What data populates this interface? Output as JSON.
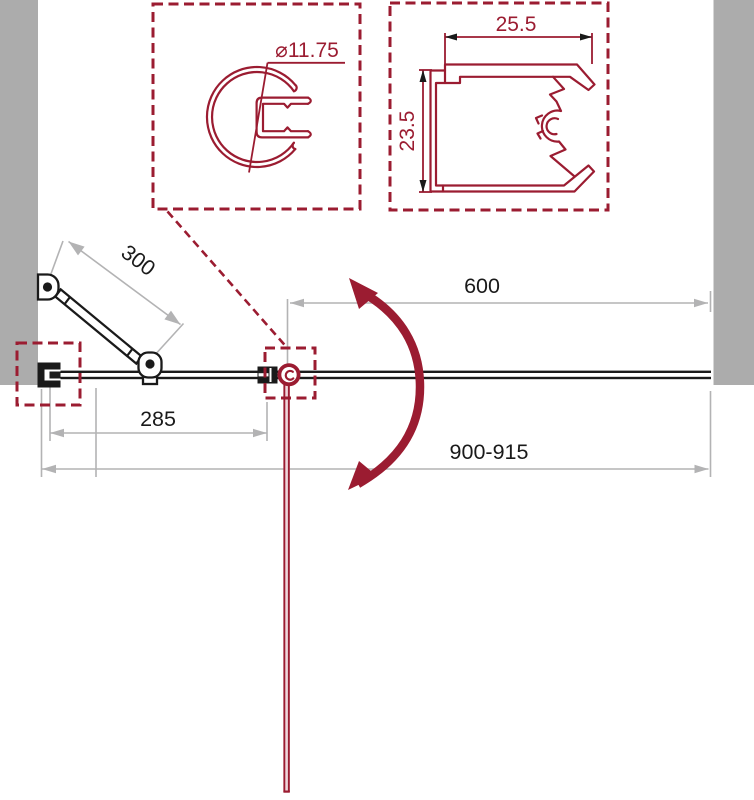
{
  "colors": {
    "red": "#9B1C31",
    "wall": "#ACACAC",
    "dim": "#B3B3B4",
    "ink": "#1A1A1A",
    "doorpink": "#EFD6DC"
  },
  "detail_left": {
    "diameter": "⌀11.75"
  },
  "detail_right": {
    "width": "25.5",
    "height": "23.5"
  },
  "dims": {
    "support_bar": "300",
    "fixed_panel": "285",
    "door": "600",
    "overall": "900-915"
  }
}
